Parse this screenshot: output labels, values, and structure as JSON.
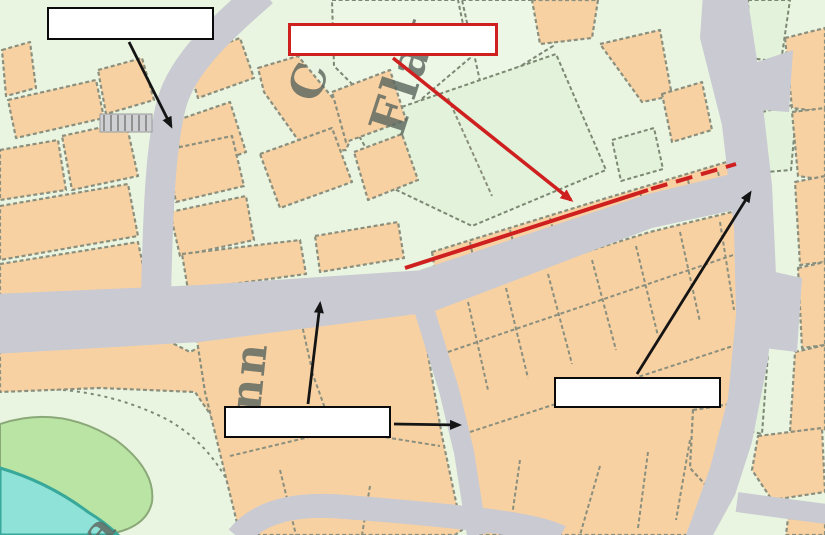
{
  "scene": {
    "description": "Ordnance-Survey style street map extract annotated with four blank white callout boxes, black pointer arrows and a red solid-then-dashed line highlighting a street"
  },
  "map_text": {
    "street_fragment_1": "C",
    "street_fragment_2": "Flat",
    "inn_fragment": "nn",
    "park_fragment": "a"
  },
  "callouts": {
    "top_left": {
      "label": "",
      "border_color": "#0a0a0a"
    },
    "top_center": {
      "label": "",
      "border_color": "#cf2020"
    },
    "bottom_center": {
      "label": "",
      "border_color": "#0a0a0a"
    },
    "right": {
      "label": "",
      "border_color": "#0a0a0a"
    }
  },
  "annotations": {
    "red_line_style": "solid then dashed",
    "black_arrow_count": 4,
    "red_arrow_count": 1
  },
  "colors": {
    "building": "#f8d1a3",
    "parcel_green": "#e3f2da",
    "road_grey": "#c9cad2",
    "outline": "#8b8f7d",
    "park_green": "#b9e4a4",
    "water_cyan": "#8ee2d8",
    "water_edge": "#38a89a",
    "annotation_red": "#cf2020",
    "annotation_black": "#141414",
    "box_fill": "#ffffff",
    "map_text_grey": "#5d685f"
  }
}
